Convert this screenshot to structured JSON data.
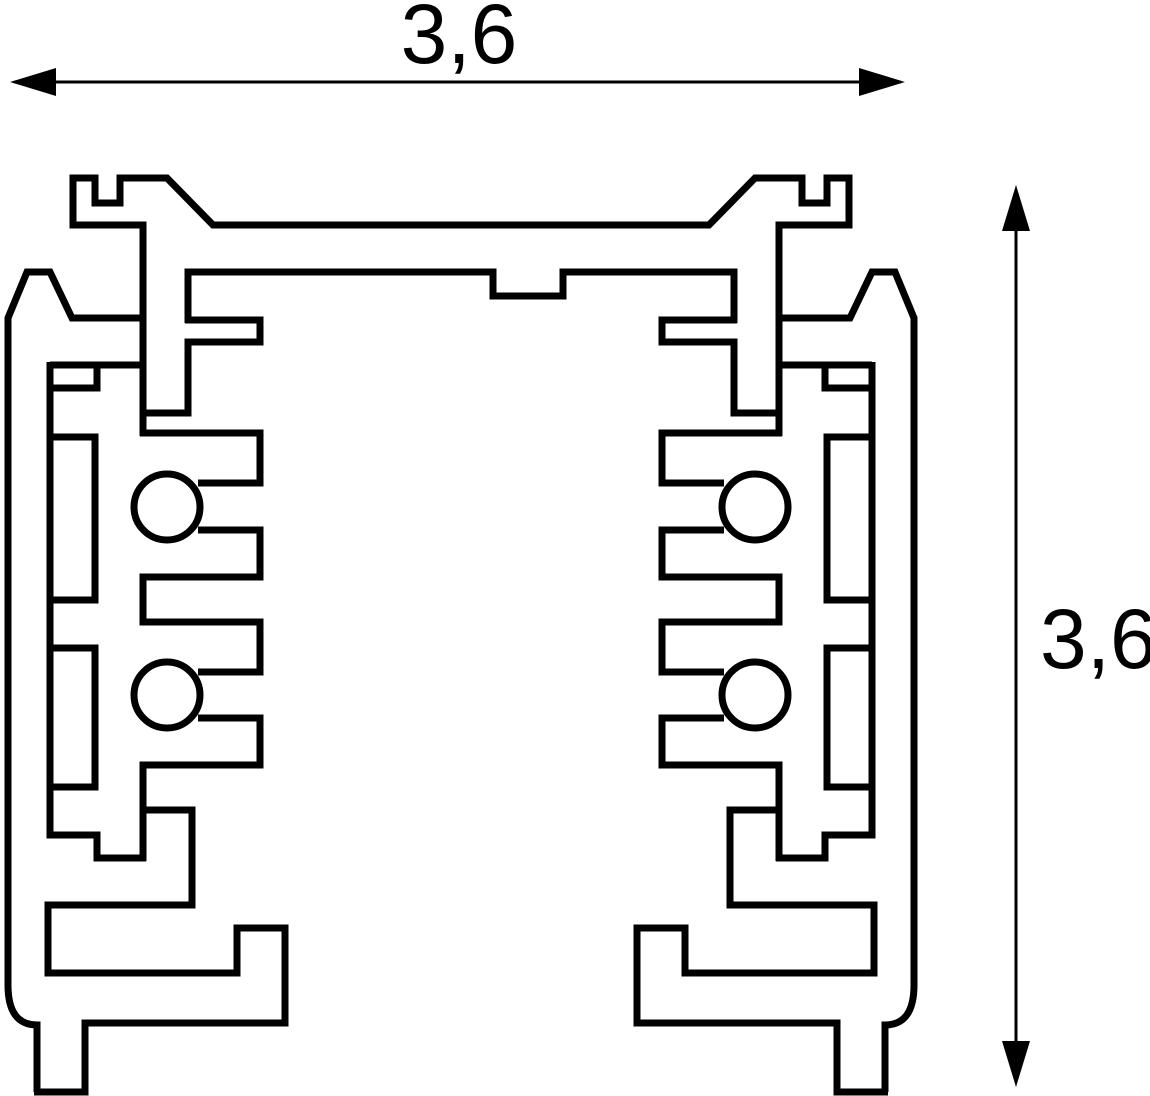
{
  "page": {
    "background": "#ffffff"
  },
  "diagram": {
    "type": "technical-cross-section",
    "subject": "3-circuit lighting track profile cross-section",
    "line_color": "#000000",
    "dimensions": {
      "width": {
        "value": "3,6",
        "orientation": "horizontal",
        "position": "top"
      },
      "height": {
        "value": "3,6",
        "orientation": "vertical",
        "position": "right"
      }
    },
    "features": {
      "conductor_holes": 4,
      "symmetry": "vertical-mirror"
    }
  }
}
